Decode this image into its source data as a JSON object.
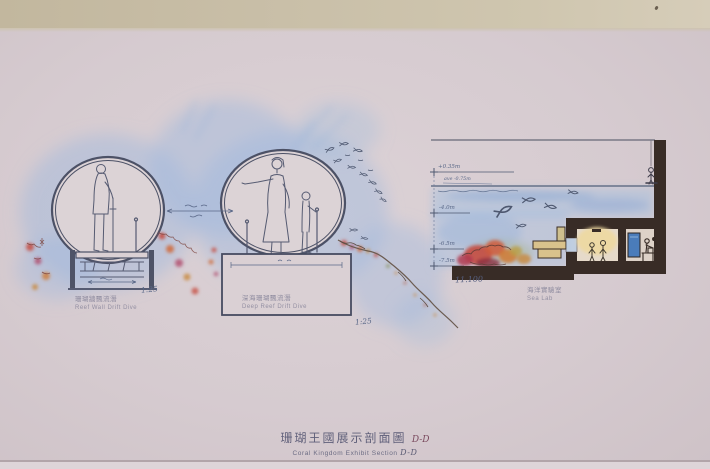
{
  "title": {
    "cn": "珊瑚王國展示剖面圖",
    "en": "Coral Kingdom Exhibit Section",
    "ref": "D-D"
  },
  "labels": {
    "reef_wall": {
      "cn": "珊瑚牆飄流潛",
      "en": "Reef Wall Drift Dive",
      "scale": "1:25"
    },
    "deep_reef": {
      "cn": "深海珊瑚飄流潛",
      "en": "Deep Reef Drift Dive",
      "scale": "1:25"
    },
    "sea_lab": {
      "cn": "海洋實驗室",
      "en": "Sea Lab"
    }
  },
  "levels": {
    "top": "+0.35m",
    "average": "ave -0.75m",
    "mid": "-4.0m",
    "low1": "-6.5m",
    "low2": "-7.5m",
    "total_depth": "11.100"
  },
  "colors": {
    "paper": "#d6cbd0",
    "top_strip": "#c9bfa8",
    "watercolor_blue": "#9db9de",
    "ink_line": "#565b72",
    "structure_dark": "#382c26",
    "coral_red": "#c5463a",
    "coral_orange": "#d07a33",
    "lab_glow": "#eed9a0",
    "panel_blue": "#4a7cba",
    "title_text": "#60607a"
  }
}
